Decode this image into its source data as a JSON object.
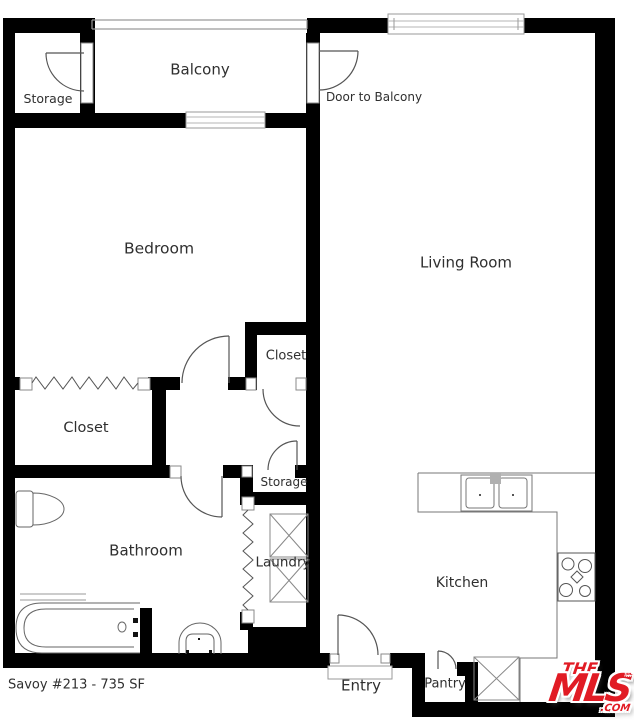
{
  "plan": {
    "labels": {
      "balcony": "Balcony",
      "storage_balcony": "Storage",
      "door_to_balcony": "Door to Balcony",
      "bedroom": "Bedroom",
      "living_room": "Living Room",
      "closet_small": "Closet",
      "closet_large": "Closet",
      "storage_hall": "Storage",
      "bathroom": "Bathroom",
      "laundry": "Laundry",
      "kitchen": "Kitchen",
      "entry": "Entry",
      "pantry": "Pantry"
    },
    "footer": {
      "listing": "Savoy #213 - 735 SF"
    },
    "fixtures": [
      "bathtub",
      "toilet",
      "pedestal-sink",
      "kitchen-double-sink",
      "stove",
      "washer-box",
      "dryer-box",
      "refrigerator-box"
    ],
    "colors": {
      "wall": "#000000",
      "fixture_line": "#666666",
      "label_text": "#2f2f2f",
      "logo_red": "#e11b24",
      "background": "#ffffff"
    }
  },
  "logo": {
    "the": "THE",
    "mls": "MLS",
    "tm": "™",
    "com": ".COM"
  }
}
